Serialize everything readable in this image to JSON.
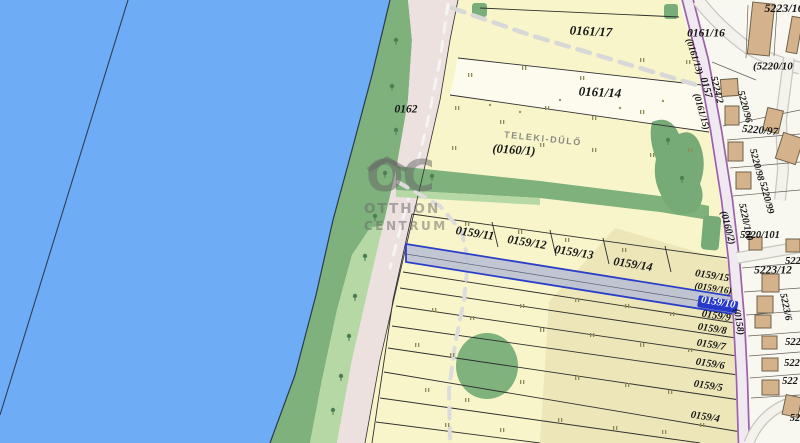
{
  "app": {
    "title": "cadastral-parcel-map"
  },
  "highlighted_parcel": {
    "id": "0159/10",
    "highlight_color": "#2B3FC8",
    "fill": "#B7BDD3"
  },
  "map_colors": {
    "water": "#6FACF6",
    "shore_green": "#7EB17C",
    "light_green": "#B5D8A4",
    "dirt_road": "#EDE1E0",
    "parcel_yellow": "#F8F5CA",
    "parcel_pale": "#FCFBEE",
    "road_purple_edge": "#9A63A3",
    "road_purple_fill": "#F1E9F2",
    "building": "#D4B28C",
    "residential_bg": "#F8F8F1"
  },
  "watermark": {
    "oc": "OC",
    "line2": "OTTHON",
    "line3": "CENTRUM"
  },
  "field_name": "TELEKI-DŰLŐ",
  "labels": [
    {
      "id": "0161-17",
      "t": "0161/17",
      "x": 591,
      "y": 31,
      "s": 13,
      "r": 3
    },
    {
      "id": "0161-14",
      "t": "0161/14",
      "x": 600,
      "y": 92,
      "s": 13,
      "r": 3
    },
    {
      "id": "0161-16",
      "t": "0161/16",
      "x": 706,
      "y": 34,
      "s": 11.5,
      "r": 0
    },
    {
      "id": "0162",
      "t": "0162",
      "x": 406,
      "y": 110,
      "s": 11.5,
      "r": 0
    },
    {
      "id": "teleki-dulo",
      "t": "TELEKI-DŰLŐ",
      "x": 543,
      "y": 139,
      "s": 9,
      "r": 6,
      "c": "gray"
    },
    {
      "id": "0160-1",
      "t": "(0160/1)",
      "x": 514,
      "y": 150,
      "s": 12.5,
      "r": 4
    },
    {
      "id": "0159-11",
      "t": "0159/11",
      "x": 475,
      "y": 233,
      "s": 12,
      "r": 9
    },
    {
      "id": "0159-12",
      "t": "0159/12",
      "x": 527,
      "y": 242,
      "s": 12,
      "r": 9
    },
    {
      "id": "0159-13",
      "t": "0159/13",
      "x": 574,
      "y": 252,
      "s": 12,
      "r": 9
    },
    {
      "id": "0159-14",
      "t": "0159/14",
      "x": 633,
      "y": 264,
      "s": 12,
      "r": 9
    },
    {
      "id": "0159-15",
      "t": "0159/15",
      "x": 712,
      "y": 277,
      "s": 10.5,
      "r": 9
    },
    {
      "id": "0159-16",
      "t": "(0159/16)",
      "x": 713,
      "y": 290,
      "s": 9.5,
      "r": 9
    },
    {
      "id": "0159-10",
      "t": "0159/10",
      "x": 718,
      "y": 304,
      "s": 10.5,
      "r": 9,
      "c": "hl"
    },
    {
      "id": "0159-9",
      "t": "0159/9",
      "x": 716,
      "y": 317,
      "s": 10.5,
      "r": 9
    },
    {
      "id": "0159-8",
      "t": "0159/8",
      "x": 712,
      "y": 330,
      "s": 10.5,
      "r": 9
    },
    {
      "id": "0159-7",
      "t": "0159/7",
      "x": 711,
      "y": 346,
      "s": 10.5,
      "r": 9
    },
    {
      "id": "0159-6",
      "t": "0159/6",
      "x": 710,
      "y": 365,
      "s": 10.5,
      "r": 9
    },
    {
      "id": "0159-5",
      "t": "0159/5",
      "x": 708,
      "y": 387,
      "s": 10.5,
      "r": 9
    },
    {
      "id": "0159-4",
      "t": "0159/4",
      "x": 705,
      "y": 418,
      "s": 10.5,
      "r": 9
    },
    {
      "id": "5223-16",
      "t": "5223/16",
      "x": 784,
      "y": 8,
      "s": 12,
      "r": 0
    },
    {
      "id": "5220-10",
      "t": "(5220/10",
      "x": 753,
      "y": 67,
      "s": 11,
      "r": 0,
      "a": "start"
    },
    {
      "id": "0161-13",
      "t": "(0161/13)",
      "x": 693,
      "y": 57,
      "s": 9.5,
      "r": 72
    },
    {
      "id": "0157",
      "t": "0157",
      "x": 705,
      "y": 88,
      "s": 10.5,
      "r": 74
    },
    {
      "id": "0161-15",
      "t": "(0161/15)",
      "x": 700,
      "y": 112,
      "s": 9.5,
      "r": 74
    },
    {
      "id": "5224-2",
      "t": "5224/2",
      "x": 716,
      "y": 90,
      "s": 10,
      "r": 76
    },
    {
      "id": "5220-96",
      "t": "5220/96",
      "x": 744,
      "y": 107,
      "s": 10,
      "r": 75
    },
    {
      "id": "5220-97",
      "t": "5220/97",
      "x": 760,
      "y": 131,
      "s": 11,
      "r": 5
    },
    {
      "id": "5220-98",
      "t": "5220/98",
      "x": 756,
      "y": 165,
      "s": 10,
      "r": 75
    },
    {
      "id": "5220-99",
      "t": "5220/99",
      "x": 766,
      "y": 198,
      "s": 10,
      "r": 75
    },
    {
      "id": "5220-100",
      "t": "5220/100",
      "x": 745,
      "y": 222,
      "s": 10,
      "r": 78
    },
    {
      "id": "5220-101",
      "t": "5220/101",
      "x": 760,
      "y": 236,
      "s": 10.5,
      "r": 0
    },
    {
      "id": "0160-2",
      "t": "(0160/2)",
      "x": 727,
      "y": 228,
      "s": 10,
      "r": 75
    },
    {
      "id": "5223-12",
      "t": "5223/12",
      "x": 773,
      "y": 271,
      "s": 11.5,
      "r": 0
    },
    {
      "id": "522-a",
      "t": "522",
      "x": 793,
      "y": 262,
      "s": 10.5,
      "r": 0
    },
    {
      "id": "5223-6",
      "t": "5223/6",
      "x": 785,
      "y": 307,
      "s": 10,
      "r": 78
    },
    {
      "id": "0158",
      "t": "(0158)",
      "x": 738,
      "y": 322,
      "s": 10,
      "r": 80
    },
    {
      "id": "522-b",
      "t": "522",
      "x": 793,
      "y": 343,
      "s": 10.5,
      "r": 0
    },
    {
      "id": "522-c",
      "t": "522",
      "x": 792,
      "y": 364,
      "s": 10.5,
      "r": 0
    },
    {
      "id": "522-d",
      "t": "522",
      "x": 790,
      "y": 382,
      "s": 10.5,
      "r": 0
    },
    {
      "id": "52-e",
      "t": "52",
      "x": 795,
      "y": 419,
      "s": 10.5,
      "r": 0
    }
  ],
  "map_features": {
    "buildings": [
      {
        "x": 750,
        "y": 3,
        "w": 22,
        "h": 52,
        "r": 6
      },
      {
        "x": 789,
        "y": 17,
        "w": 11,
        "h": 36,
        "r": 10
      },
      {
        "x": 721,
        "y": 79,
        "w": 17,
        "h": 17,
        "r": -4
      },
      {
        "x": 725,
        "y": 106,
        "w": 14,
        "h": 19,
        "r": 0
      },
      {
        "x": 765,
        "y": 109,
        "w": 16,
        "h": 23,
        "r": 13
      },
      {
        "x": 779,
        "y": 135,
        "w": 21,
        "h": 27,
        "r": 18
      },
      {
        "x": 728,
        "y": 142,
        "w": 15,
        "h": 19,
        "r": 0
      },
      {
        "x": 736,
        "y": 172,
        "w": 15,
        "h": 17,
        "r": 0
      },
      {
        "x": 749,
        "y": 237,
        "w": 13,
        "h": 13,
        "r": 0
      },
      {
        "x": 786,
        "y": 239,
        "w": 14,
        "h": 13,
        "r": 0
      },
      {
        "x": 762,
        "y": 274,
        "w": 17,
        "h": 18,
        "r": 0
      },
      {
        "x": 757,
        "y": 296,
        "w": 16,
        "h": 17,
        "r": 0
      },
      {
        "x": 755,
        "y": 315,
        "w": 16,
        "h": 13,
        "r": 0
      },
      {
        "x": 762,
        "y": 336,
        "w": 15,
        "h": 13,
        "r": 0
      },
      {
        "x": 762,
        "y": 358,
        "w": 16,
        "h": 13,
        "r": 0
      },
      {
        "x": 762,
        "y": 380,
        "w": 17,
        "h": 15,
        "r": 0
      },
      {
        "x": 784,
        "y": 396,
        "w": 16,
        "h": 20,
        "r": 12
      }
    ],
    "grass_marks": [
      [
        468,
        73
      ],
      [
        522,
        66
      ],
      [
        580,
        76
      ],
      [
        640,
        58
      ],
      [
        686,
        60
      ],
      [
        455,
        106
      ],
      [
        500,
        120
      ],
      [
        545,
        106
      ],
      [
        592,
        116
      ],
      [
        640,
        110
      ],
      [
        452,
        146
      ],
      [
        540,
        143
      ],
      [
        592,
        148
      ],
      [
        650,
        153
      ],
      [
        688,
        148
      ],
      [
        465,
        222
      ],
      [
        518,
        230
      ],
      [
        565,
        238
      ],
      [
        622,
        248
      ],
      [
        432,
        308
      ],
      [
        470,
        316
      ],
      [
        520,
        304
      ],
      [
        575,
        298
      ],
      [
        625,
        304
      ],
      [
        670,
        312
      ],
      [
        415,
        343
      ],
      [
        450,
        353
      ],
      [
        540,
        328
      ],
      [
        590,
        333
      ],
      [
        640,
        343
      ],
      [
        688,
        348
      ],
      [
        425,
        388
      ],
      [
        465,
        398
      ],
      [
        520,
        380
      ],
      [
        575,
        376
      ],
      [
        625,
        383
      ],
      [
        668,
        390
      ],
      [
        445,
        423
      ],
      [
        500,
        428
      ],
      [
        558,
        418
      ],
      [
        613,
        426
      ],
      [
        662,
        430
      ],
      [
        700,
        423
      ]
    ],
    "tree_marks": [
      [
        396,
        40
      ],
      [
        392,
        86
      ],
      [
        396,
        130
      ],
      [
        385,
        173
      ],
      [
        375,
        216
      ],
      [
        365,
        256
      ],
      [
        355,
        296
      ],
      [
        349,
        336
      ],
      [
        341,
        376
      ],
      [
        333,
        410
      ],
      [
        668,
        140
      ],
      [
        682,
        178
      ],
      [
        432,
        176
      ]
    ],
    "dots": [
      [
        490,
        105
      ],
      [
        560,
        100
      ],
      [
        620,
        108
      ],
      [
        663,
        101
      ],
      [
        520,
        112
      ]
    ]
  }
}
